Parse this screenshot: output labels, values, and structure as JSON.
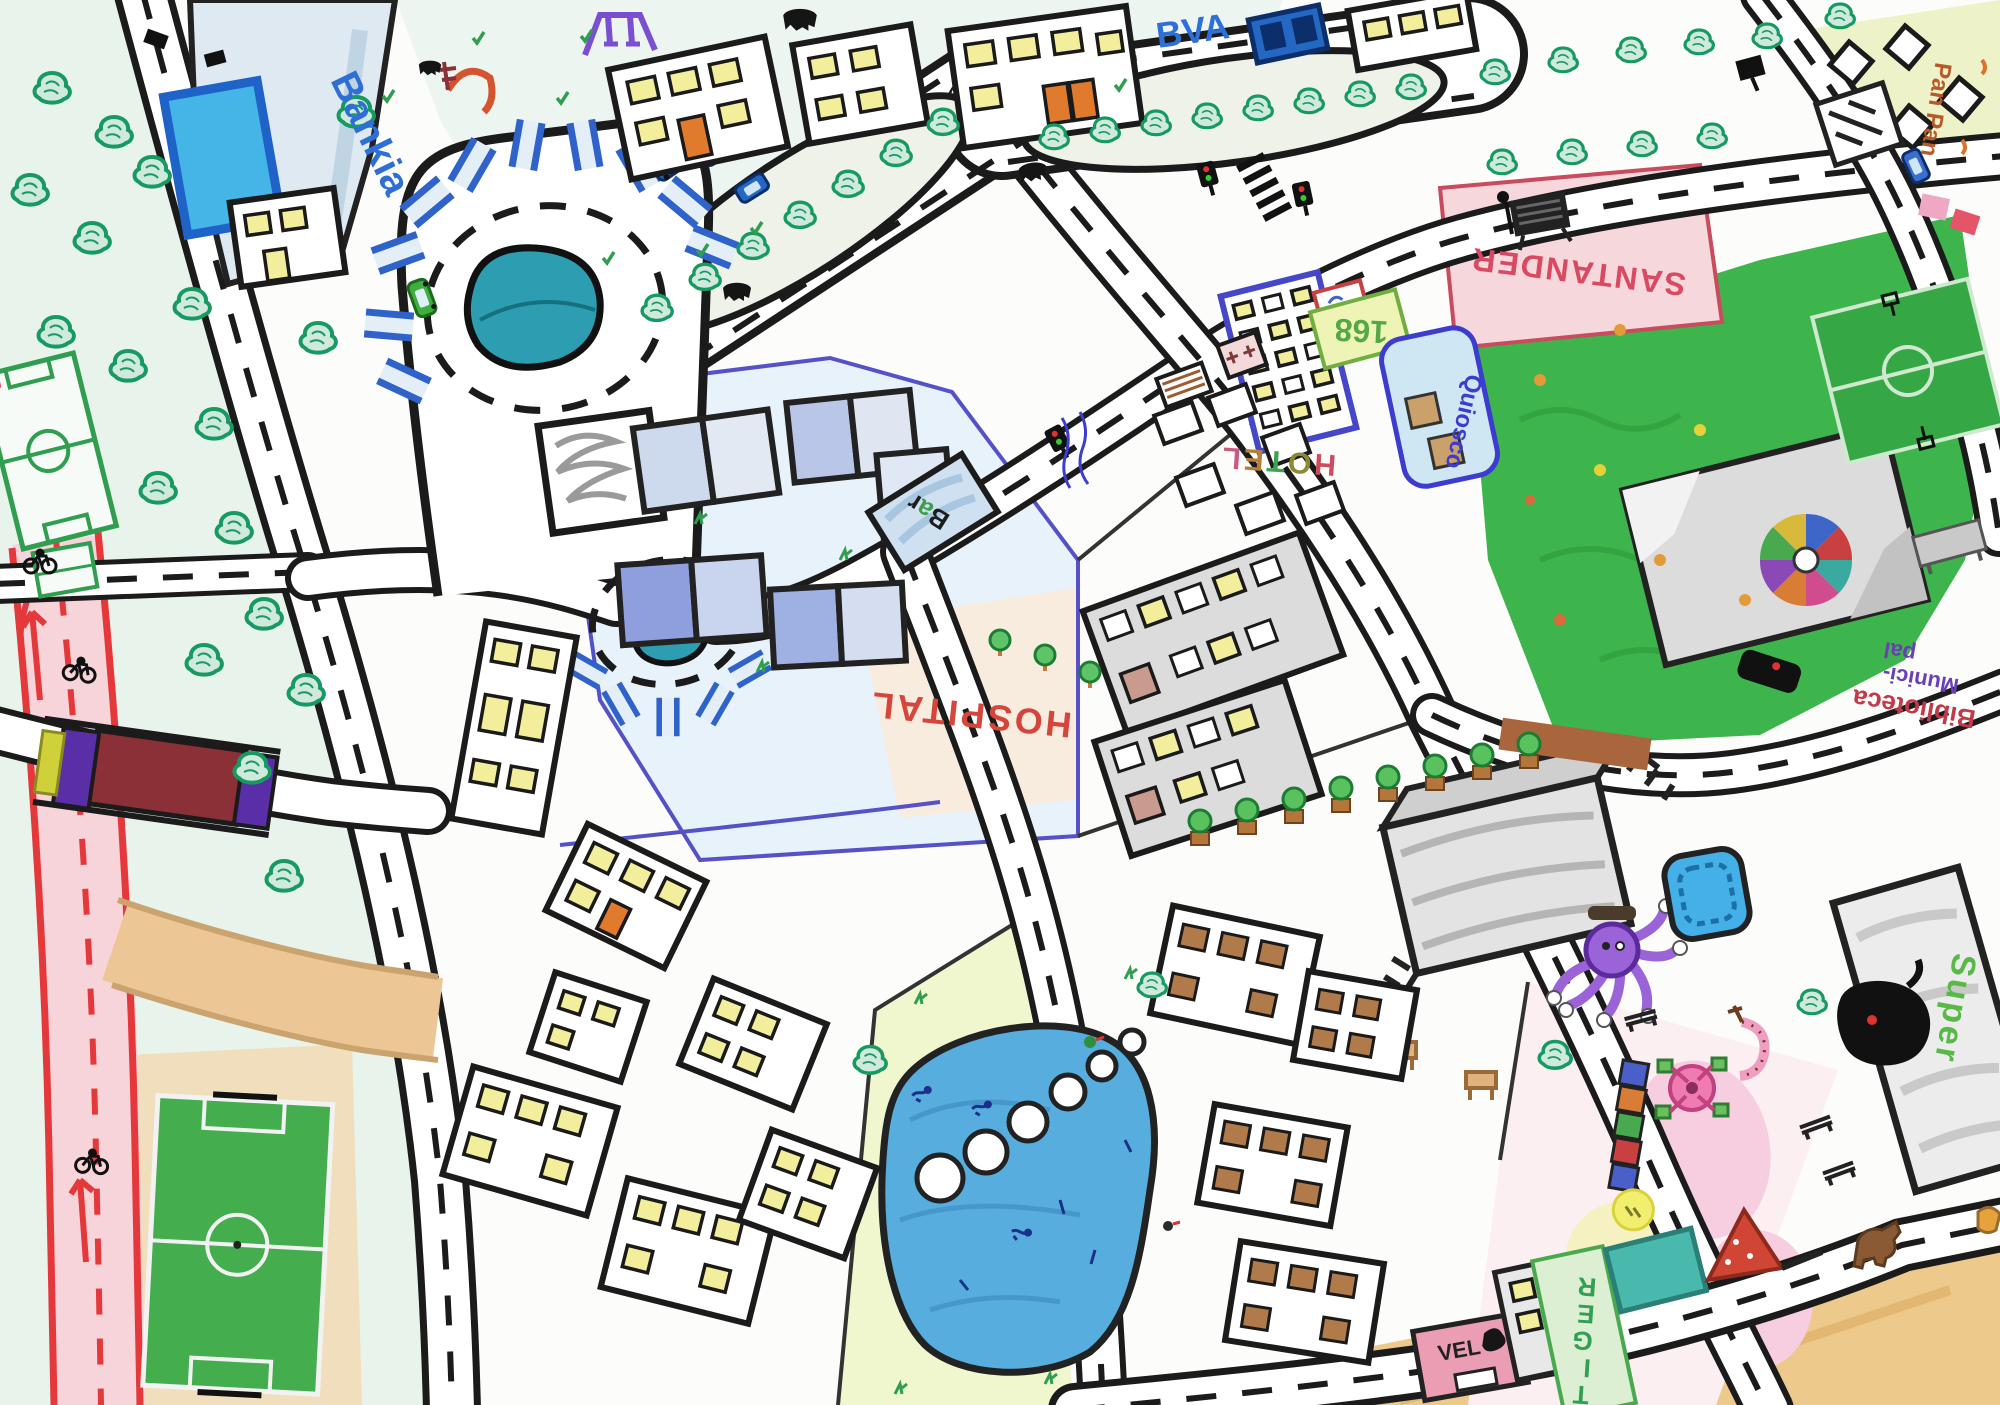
{
  "meta": {
    "type": "hand-drawn children's city map",
    "medium": "marker and colored pencil on paper"
  },
  "labels": {
    "bankia": "Bankia",
    "bva": "BVA",
    "pan_pan": "Pan Pan",
    "santander": "SANTANDER",
    "quiosco": "Quiosco",
    "bus_number": "168",
    "hotel_letters": [
      "H",
      "O",
      "T",
      "E",
      "L"
    ],
    "bar_letters": [
      "B",
      "a",
      "r"
    ],
    "hospital": "HOSPITAL",
    "biblioteca_line1": "Biblioteca",
    "biblioteca_line2": "Munici-",
    "biblioteca_line3": "pal",
    "super": "Super",
    "vel": "VEL",
    "tiger_letters": [
      "T",
      "I",
      "G",
      "E",
      "R"
    ]
  },
  "features": [
    "bankia-bank",
    "bbva-bank",
    "playground-top",
    "parking-loop-with-pond",
    "pond-roundabout",
    "tree-lined-avenue",
    "hospital-complex",
    "bar",
    "hotel",
    "bus-stop-168",
    "santander-bank",
    "quiosco-kiosk",
    "city-park-with-plaza",
    "mosaic-plaza",
    "basketball-court",
    "biblioteca-municipal-library",
    "pan-pan-bakery",
    "supermarket",
    "music-shop",
    "vel-shop",
    "tiger-store",
    "children-playground",
    "pond-park-with-stepping-stones",
    "soccer-field-south",
    "soccer-field-north",
    "bike-lane",
    "bridge-over-bike-lane",
    "monument-building",
    "residential-blocks",
    "dirt-road",
    "crosswalk",
    "traffic-lights",
    "parked-cars",
    "cows",
    "cyclists",
    "swimmers"
  ],
  "colors": {
    "pond_teal": "#2d9db1",
    "park_green": "#3eb44d",
    "bike_lane_pink": "#f7d3da",
    "bike_lane_red": "#e5383b",
    "hospital_blue": "#e8f2fa",
    "santander_pink": "#f6d7dc",
    "bridge_maroon": "#8c3038",
    "bridge_purple": "#5a2ea6",
    "label_blue": "#2e6fd6",
    "label_red": "#d6453c",
    "label_green": "#58b947",
    "tree_green": "#169a62",
    "dirt_tan": "#ecc795"
  }
}
